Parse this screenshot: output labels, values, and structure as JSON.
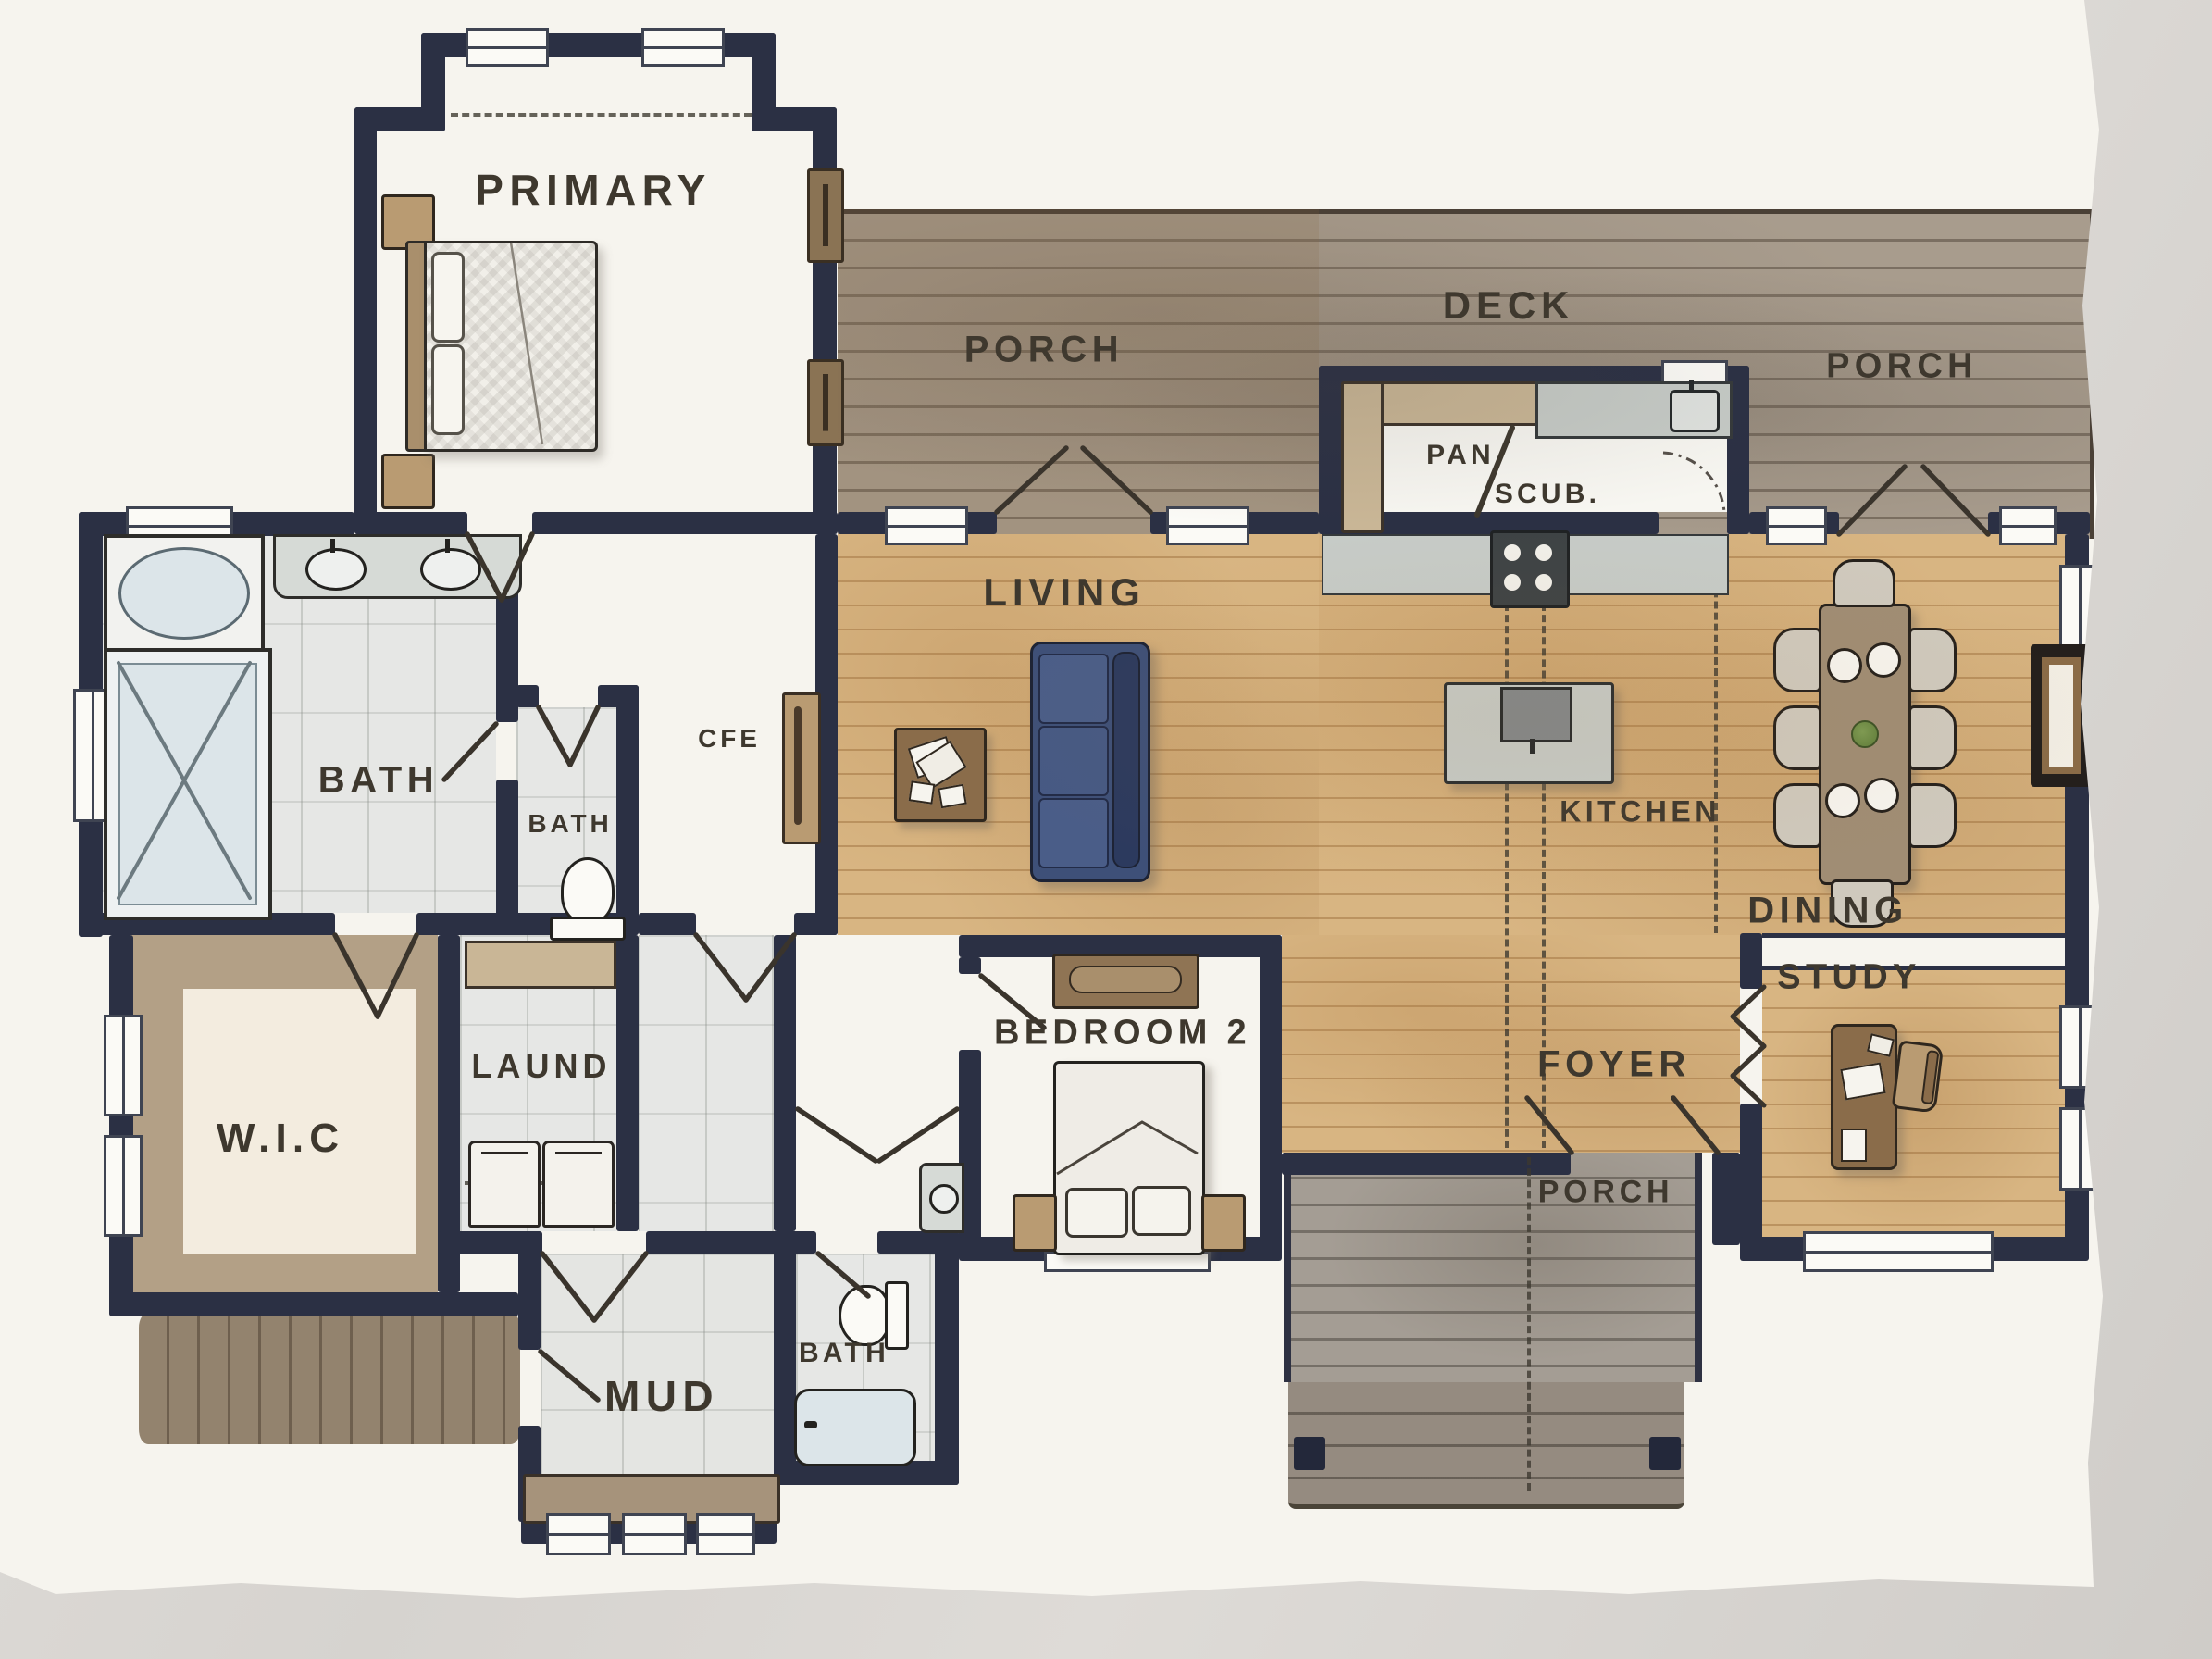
{
  "artwork": {
    "kind": "hand-painted watercolor floor plan on textured paper",
    "paper_edge": "deckled right and bottom edges over light marble surface"
  },
  "palette": {
    "bg": "#d8d4cf",
    "paper": "#f6f4ee",
    "wall": "#2b3044",
    "label": "#3e382e",
    "wood": "#d8b582",
    "deck": "#a89c8d",
    "porch_front": "#a49d94",
    "stoop": "#93836e",
    "tile": "#e6e7e5",
    "taupe": "#b3a086",
    "cream": "#f3ecdf",
    "counter": "#c6cbc7",
    "counter_dark": "#82888b",
    "sofa": "#3e5078",
    "sofa_dark": "#2c3a5e",
    "furn_brown": "#8a6c4a",
    "furn_tan": "#b99b72",
    "tub": "#dce5e9",
    "range": "#3e4345",
    "table": "#a08d74",
    "chair": "#cfc9bd",
    "fireplace": "#241f1c",
    "fireplace_inner": "#8a6b47",
    "plant": "#5e7d3a"
  },
  "rooms": {
    "primary": {
      "label": "PRIMARY"
    },
    "porch_top_left": {
      "label": "PORCH"
    },
    "deck": {
      "label": "DECK"
    },
    "porch_top_right": {
      "label": "PORCH"
    },
    "pantry": {
      "label": "PAN/SCUB.",
      "pan": "PAN",
      "scub": "SCUB."
    },
    "living": {
      "label": "LIVING"
    },
    "coffee": {
      "label": "CFE"
    },
    "bath_primary": {
      "label": "BATH"
    },
    "bath_powder": {
      "label": "BATH"
    },
    "kitchen": {
      "label": "KITCHEN"
    },
    "dining": {
      "label": "DINING"
    },
    "study": {
      "label": "STUDY"
    },
    "wic": {
      "label": "W.I.C"
    },
    "laundry": {
      "label": "LAUND"
    },
    "bedroom2": {
      "label": "BEDROOM 2"
    },
    "foyer": {
      "label": "FOYER"
    },
    "porch_front": {
      "label": "PORCH"
    },
    "mud": {
      "label": "MUD"
    },
    "bath_hall": {
      "label": "BATH"
    }
  }
}
